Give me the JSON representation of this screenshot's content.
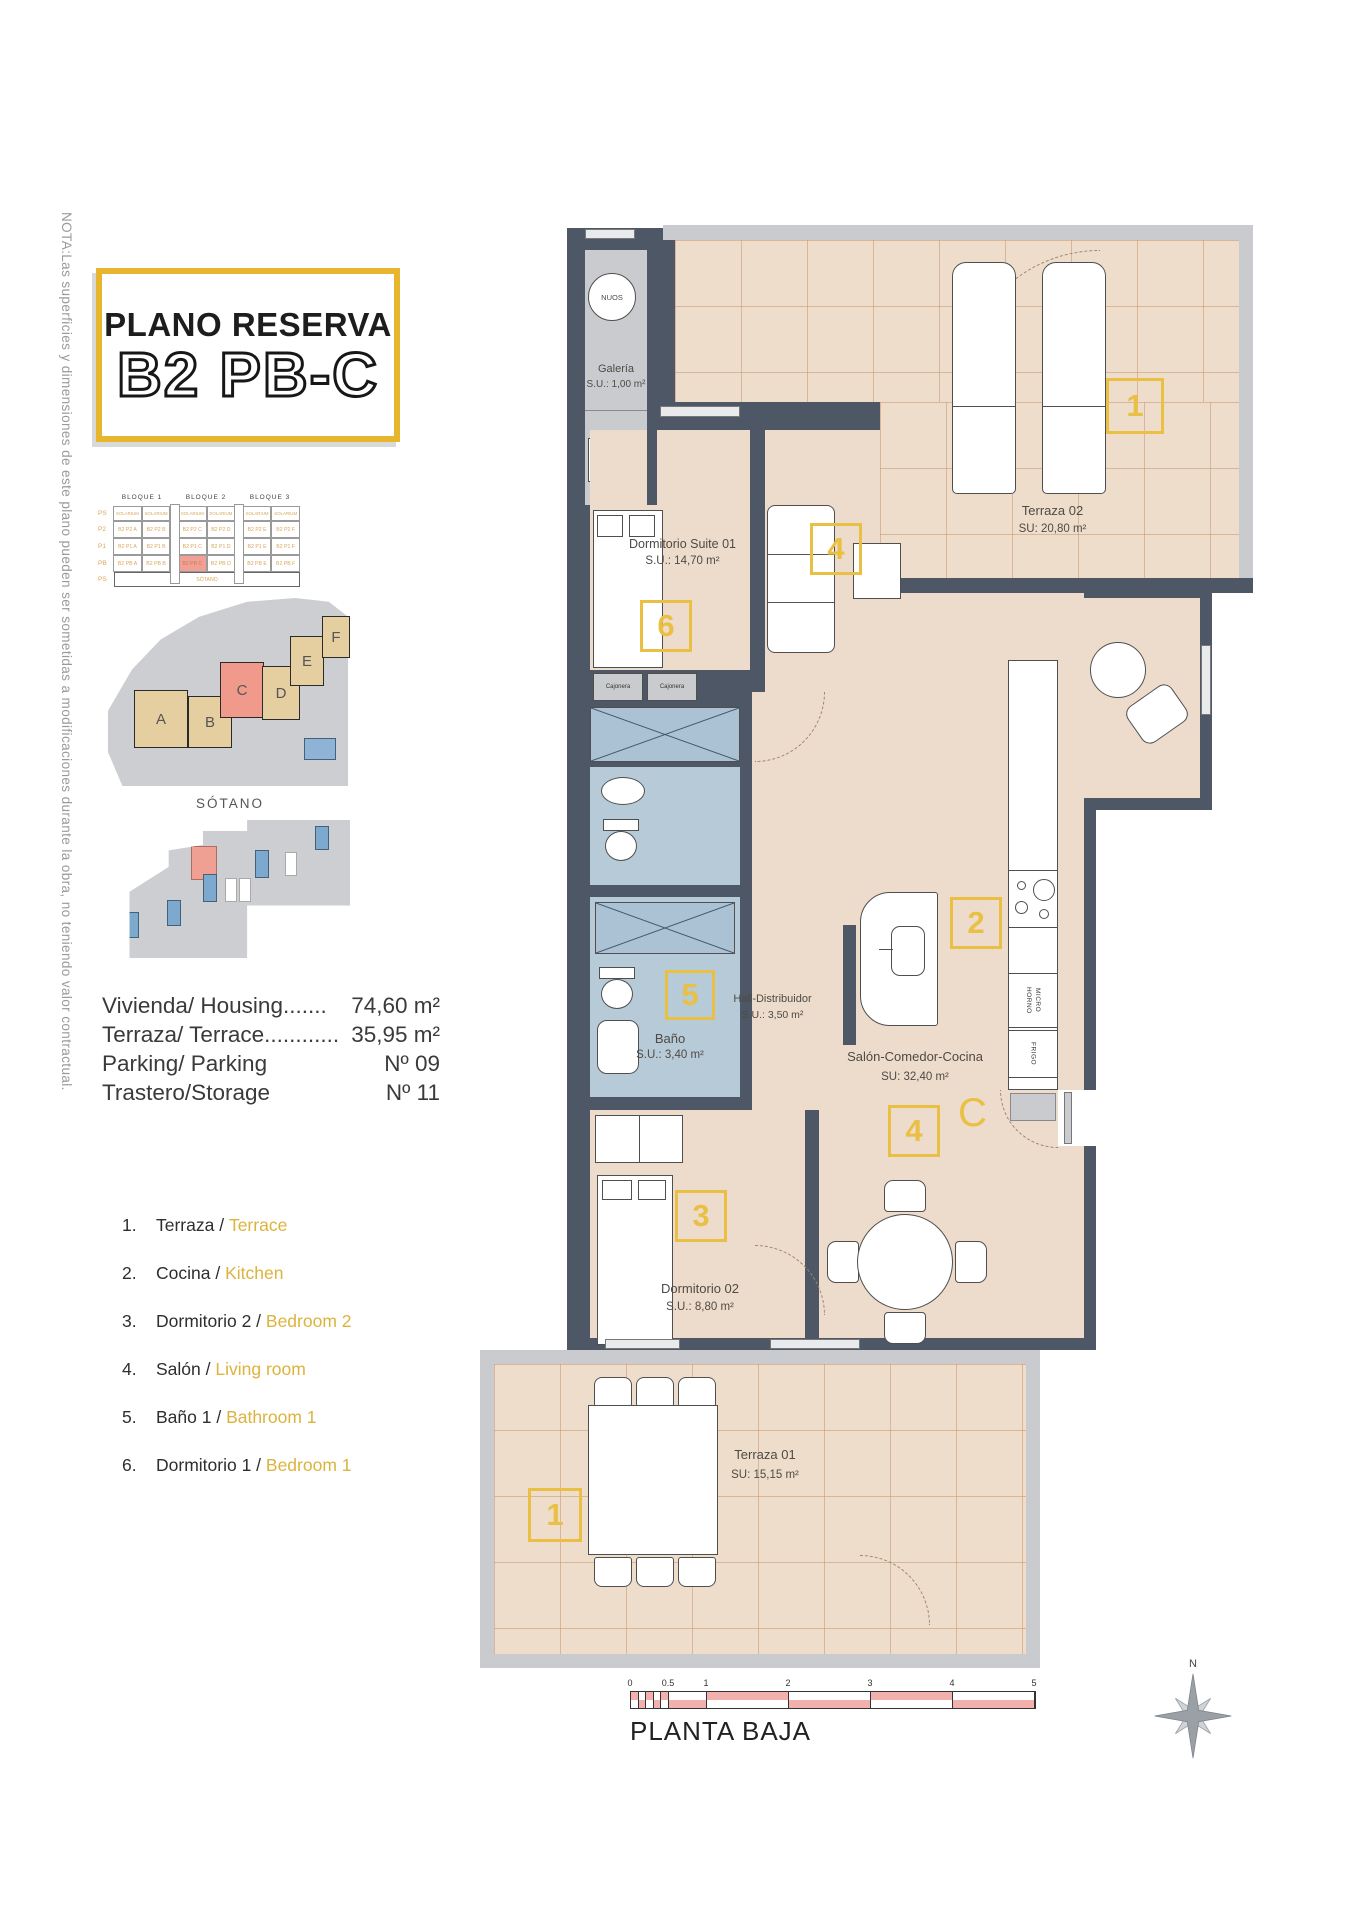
{
  "note": "NOTA:Las superficies y dimensiones de este plano pueden ser sometidas a modificaciones durante la obra, no teniendo valor contractual.",
  "title": {
    "line1": "PLANO RESERVA",
    "line2": "B2 PB-C"
  },
  "block_table": {
    "blocks": [
      "BLOQUE 1",
      "BLOQUE 2",
      "BLOQUE 3"
    ],
    "row_labels": [
      "PS",
      "P2",
      "P1",
      "PB",
      "PS"
    ],
    "solarium": "SOLARIUM",
    "units": {
      "p2": [
        "B2 P2 A",
        "B2 P2 B",
        "B2 P2 C",
        "B2 P2 D",
        "B2 P2 E",
        "B2 P2 F"
      ],
      "p1": [
        "B2 P1 A",
        "B2 P1 B",
        "B2 P1 C",
        "B2 P1 D",
        "B2 P1 E",
        "B2 P1 F"
      ],
      "pb": [
        "B2 PB A",
        "B2 PB B",
        "B2 PB C",
        "B2 PB D",
        "B2 PB E",
        "B2 PB F"
      ]
    },
    "highlight_unit": "B2 PB C",
    "sotano": "SÓTANO"
  },
  "site_plan": {
    "labels": [
      "A",
      "B",
      "C",
      "D",
      "E",
      "F"
    ],
    "highlight": "C"
  },
  "sotano_plan": {
    "label": "SÓTANO"
  },
  "areas": [
    {
      "label": "Vivienda/ Housing.......",
      "value": "74,60 m²"
    },
    {
      "label": "Terraza/ Terrace............",
      "value": "35,95 m²"
    },
    {
      "label": "Parking/ Parking",
      "value": "Nº 09"
    },
    {
      "label": "Trastero/Storage",
      "value": "Nº 11"
    }
  ],
  "legend": [
    {
      "num": "1.",
      "es": "Terraza",
      "en": "Terrace"
    },
    {
      "num": "2.",
      "es": "Cocina",
      "en": "Kitchen"
    },
    {
      "num": "3.",
      "es": "Dormitorio 2",
      "en": "Bedroom 2"
    },
    {
      "num": "4.",
      "es": "Salón",
      "en": "Living room"
    },
    {
      "num": "5.",
      "es": "Baño 1",
      "en": "Bathroom 1"
    },
    {
      "num": "6.",
      "es": "Dormitorio 1",
      "en": "Bedroom 1"
    }
  ],
  "plan": {
    "galeria": {
      "appliance": "NUOS",
      "name": "Galería",
      "area": "S.U.: 1,00 m²",
      "lav": "LAV."
    },
    "terraza02": {
      "badge": "1",
      "name": "Terraza 02",
      "area": "SU: 20,80 m²"
    },
    "suite": {
      "badge": "6",
      "name": "Dormitorio Suite 01",
      "area": "S.U.: 14,70 m²"
    },
    "cajonera_left": "Cajonera",
    "cajonera_right": "Cajonera",
    "bano": {
      "badge": "5",
      "name": "Baño",
      "area": "S.U.: 3,40 m²"
    },
    "hall": {
      "name": "Hall-Distribuidor",
      "area": "S.U.: 3,50 m²"
    },
    "salon": {
      "badge_living": "4",
      "badge_kitchen": "2",
      "badge_dining": "4",
      "entry_letter": "C",
      "name": "Salón-Comedor-Cocina",
      "area": "SU: 32,40 m²"
    },
    "kitchen": {
      "horno": "HORNO",
      "micro": "MICRO",
      "frigo": "FRIGO"
    },
    "dorm02": {
      "badge": "3",
      "name": "Dormitorio 02",
      "area": "S.U.: 8,80 m²"
    },
    "terraza01": {
      "badge": "1",
      "name": "Terraza 01",
      "area": "SU: 15,15 m²"
    }
  },
  "scalebar": {
    "ticks": [
      "0",
      "0.5",
      "1",
      "2",
      "3",
      "4",
      "5"
    ]
  },
  "floor_label": "PLANTA BAJA",
  "compass": {
    "north": "N"
  }
}
